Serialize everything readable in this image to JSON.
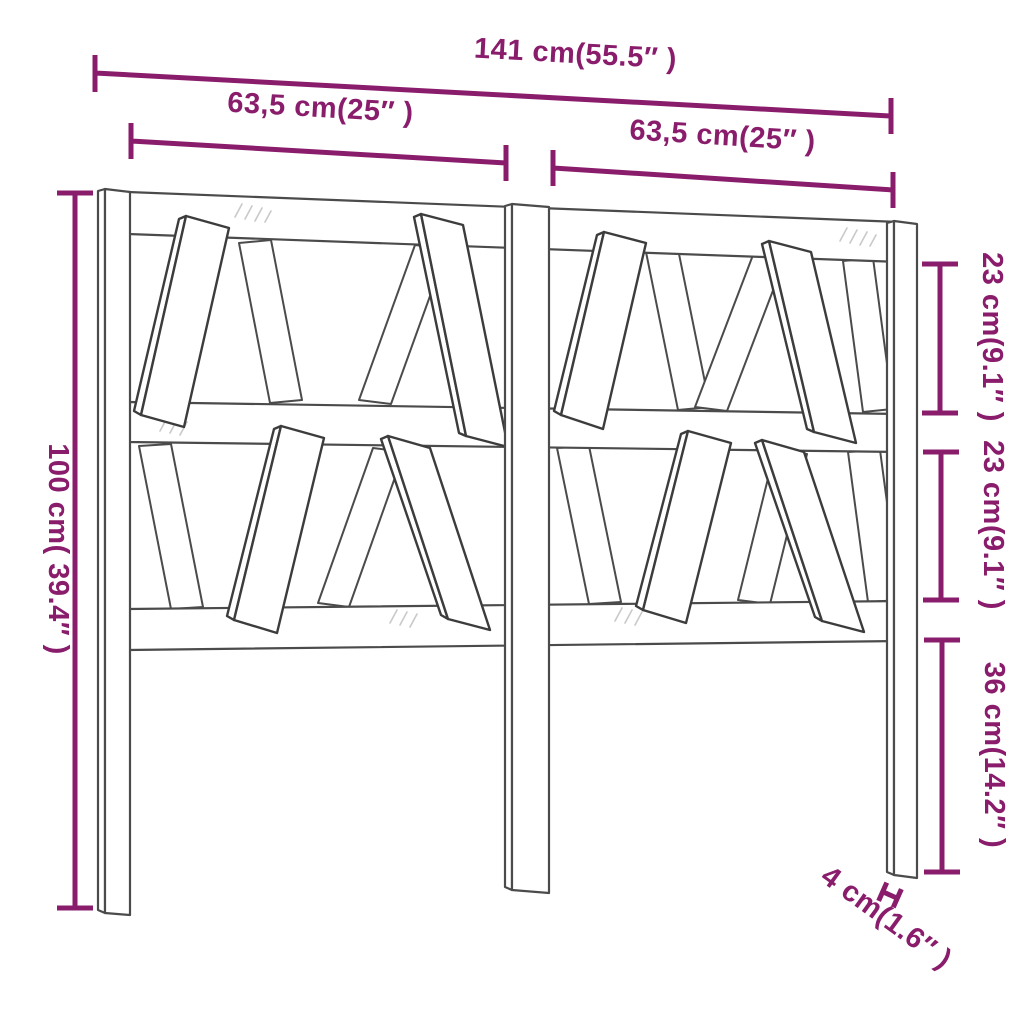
{
  "figure": {
    "title": "Headboard dimension diagram",
    "product": "slatted wood headboard line drawing",
    "accent_color": "#8A1C6C",
    "line_color": "#4b4b4b",
    "background_color": "#ffffff"
  },
  "dimensions": {
    "overall_width": {
      "label": "141 cm(55.5″ )"
    },
    "left_panel_width": {
      "label": "63,5 cm(25″ )"
    },
    "right_panel_width": {
      "label": "63,5 cm(25″ )"
    },
    "overall_height": {
      "label": "100 cm( 39.4″ )"
    },
    "upper_panel_height": {
      "label": "23 cm(9.1″ )"
    },
    "lower_panel_height": {
      "label": "23 cm(9.1″ )"
    },
    "leg_height": {
      "label": "36 cm(14.2″ )"
    },
    "leg_thickness": {
      "label": "4 cm(1.6″ )"
    }
  }
}
